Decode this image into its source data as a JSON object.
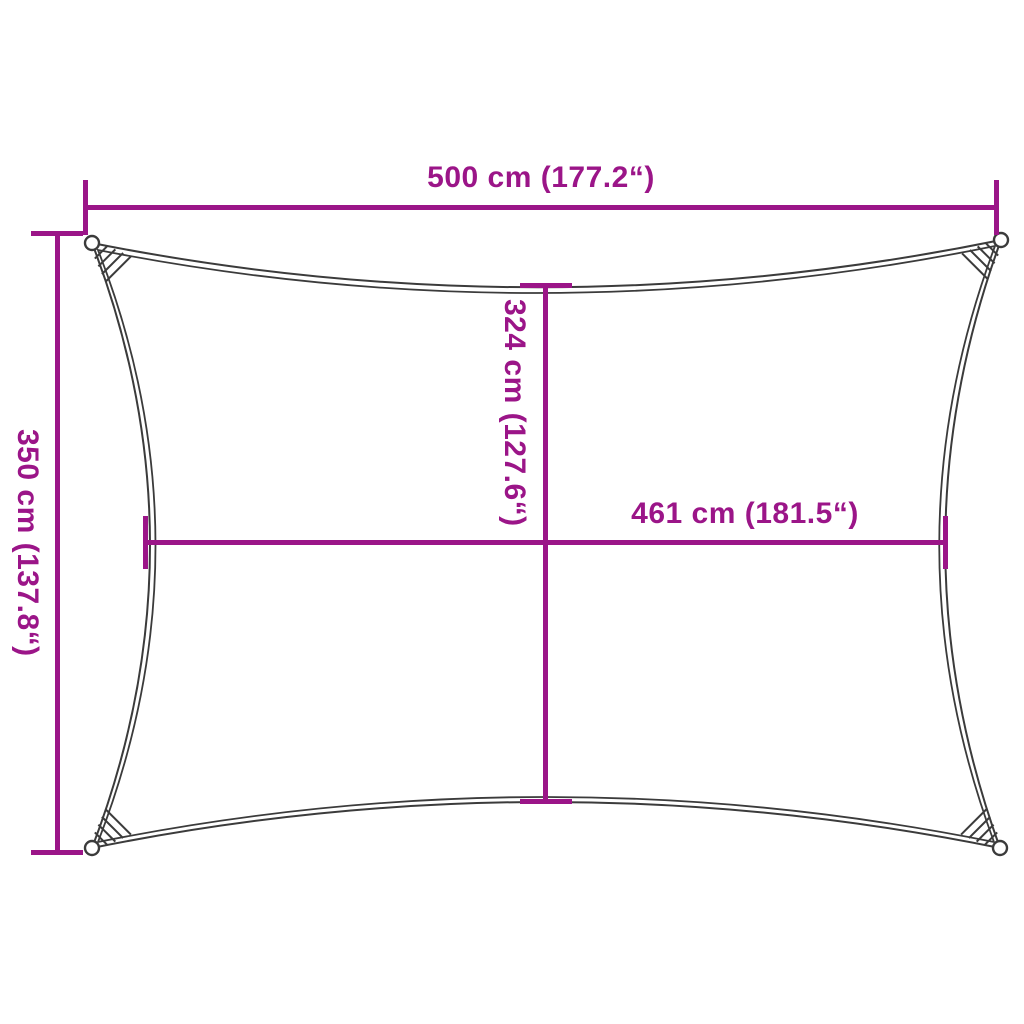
{
  "diagram": {
    "kind": "shade-sail dimension drawing",
    "dimensions": {
      "top_width": {
        "label": "500 cm (177.2“)",
        "value_cm": 500,
        "value_inch": 177.2
      },
      "left_height": {
        "label": "350 cm (137.8“)",
        "value_cm": 350,
        "value_inch": 137.8
      },
      "center_height": {
        "label": "324 cm (127.6“)",
        "value_cm": 324,
        "value_inch": 127.6
      },
      "center_width": {
        "label": "461 cm (181.5“)",
        "value_cm": 461,
        "value_inch": 181.5
      }
    },
    "colors": {
      "dimension_line": "#9B1588",
      "sail_outline": "#3B3B3B",
      "background": "#FFFFFF"
    }
  }
}
